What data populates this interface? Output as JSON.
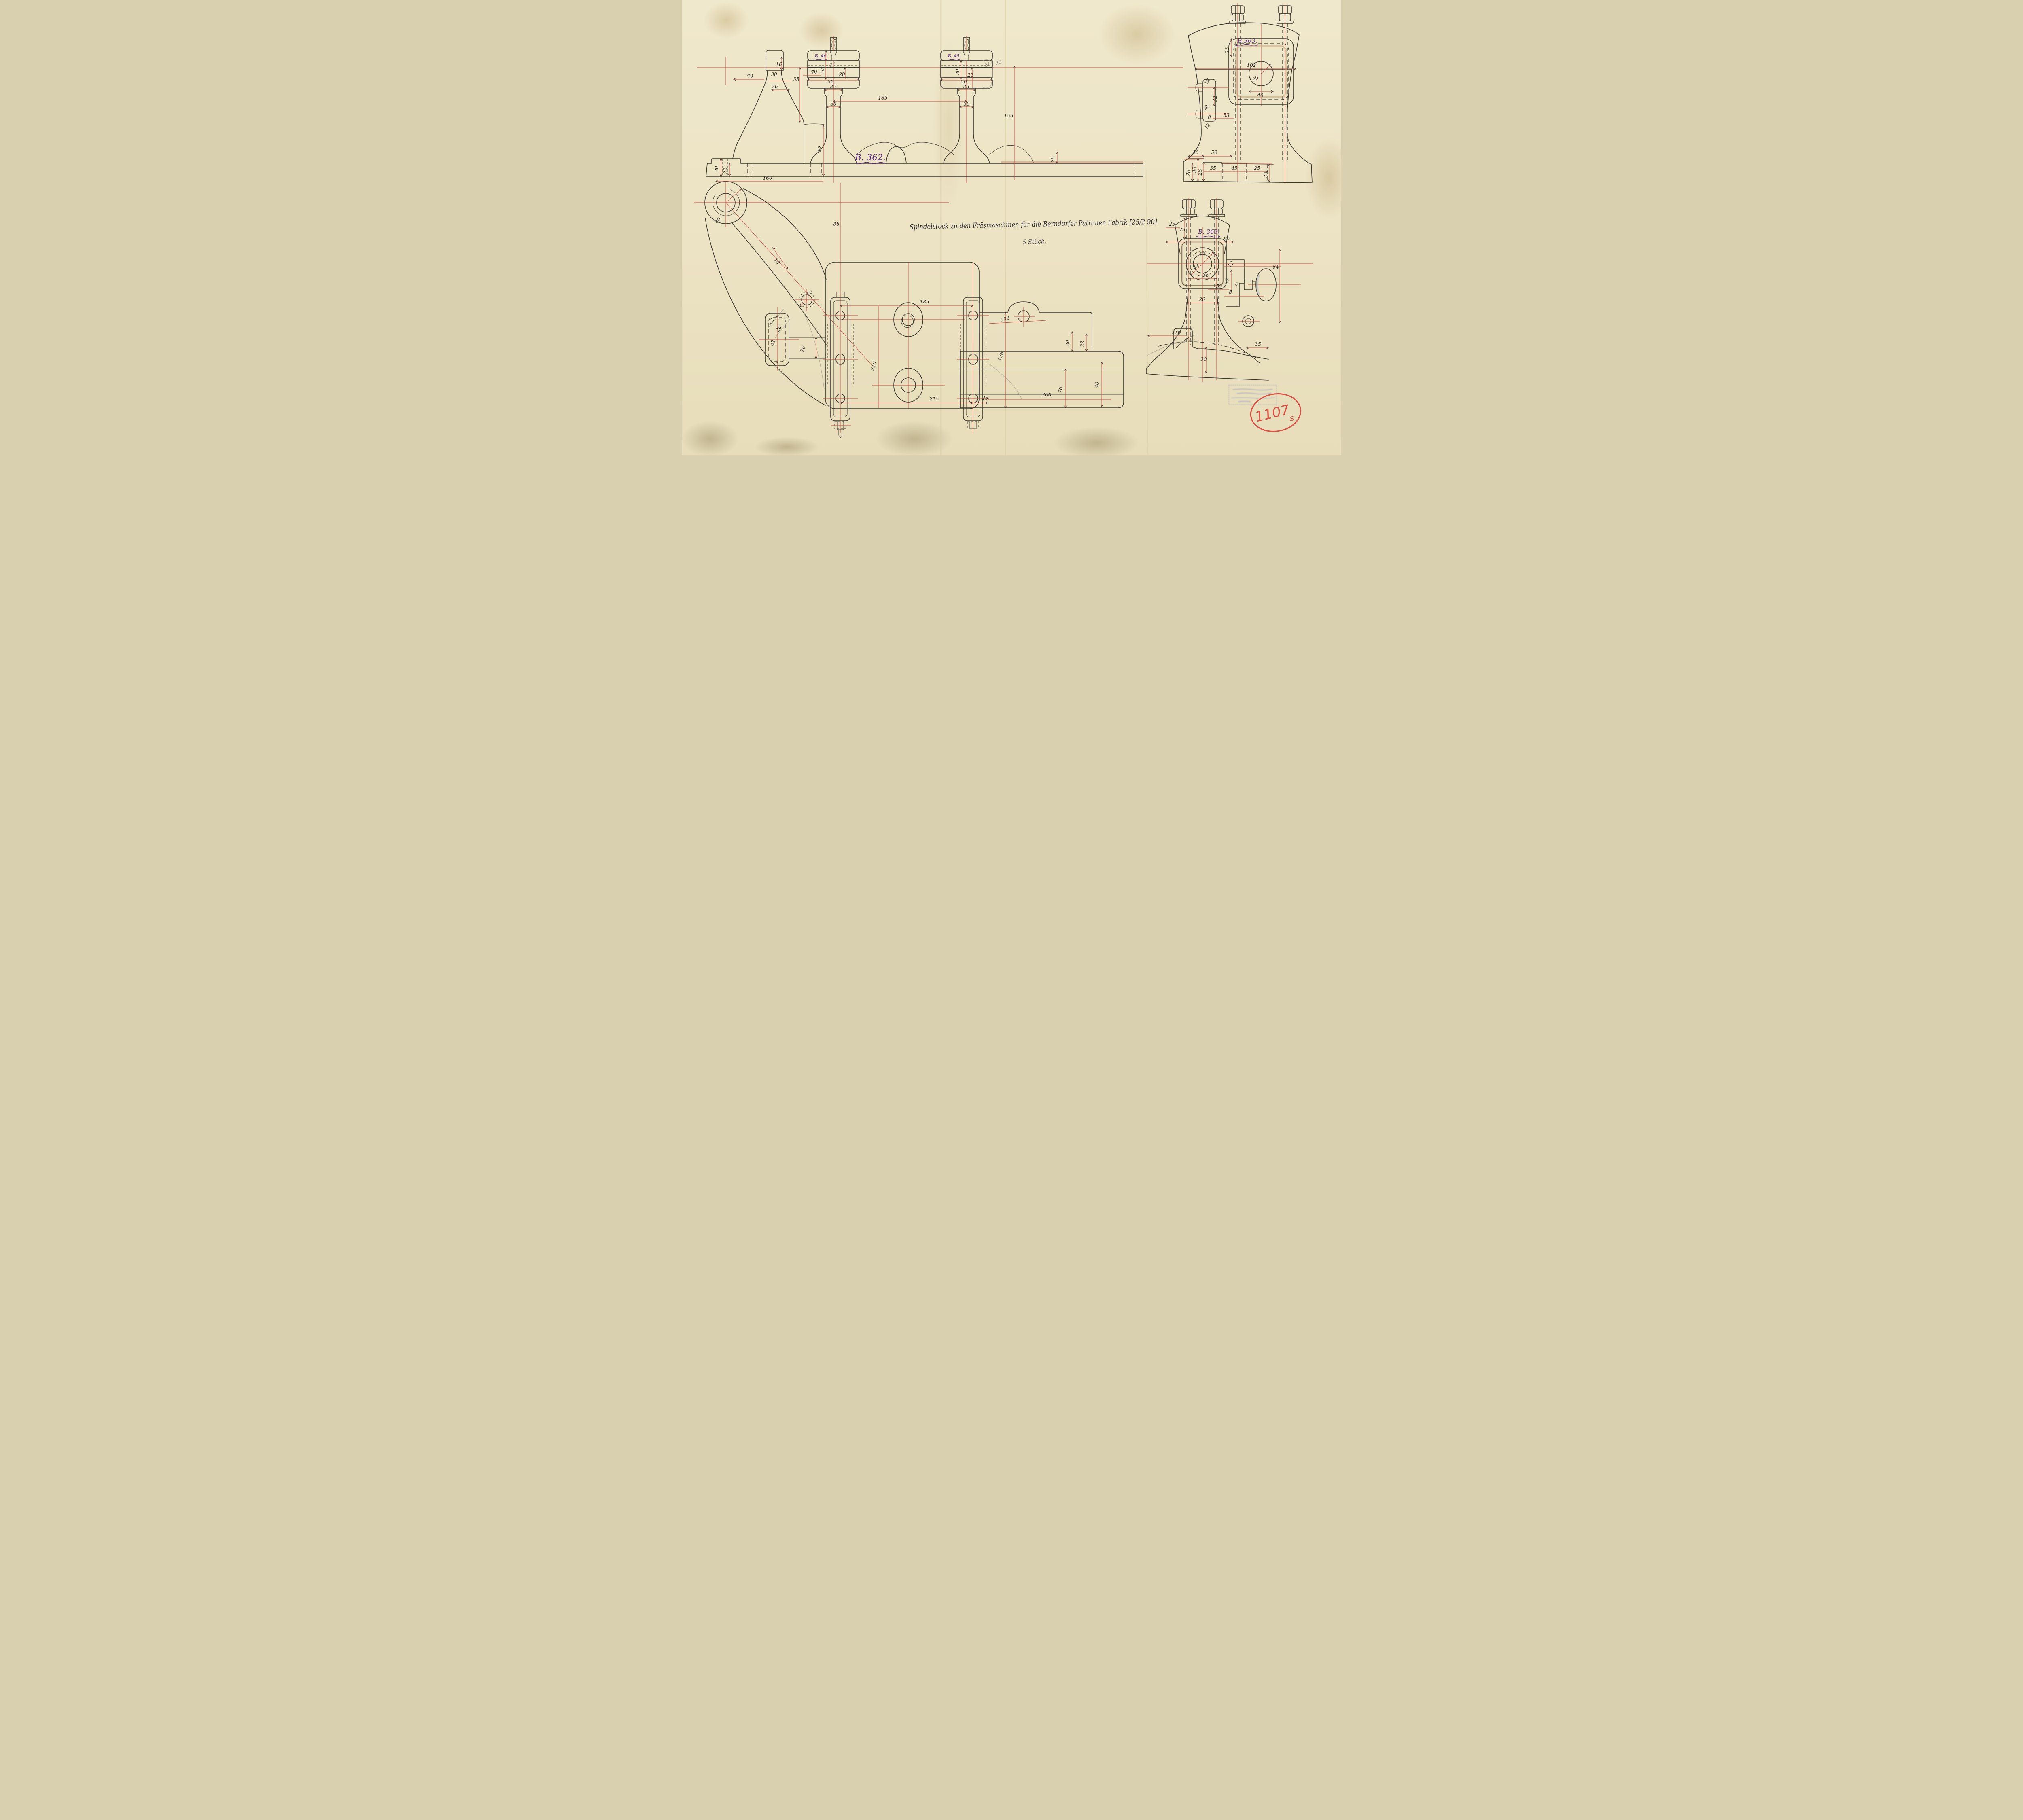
{
  "title": {
    "line1": "Spindelstock zu den Fräsmaschinen für die Berndorfer Patronen Fabrik [25/2 90]",
    "line2": "5 Stück."
  },
  "labels": {
    "b362": "B. 362.",
    "b46": "B. 46.",
    "b45": "B. 45.",
    "b363_front": "B.363.",
    "b363_side": "B. 363."
  },
  "stamp": {
    "number": "1107",
    "suffix": "s"
  },
  "colors": {
    "paper": "#eee6c9",
    "ink": "#3d382e",
    "red_line": "#c2463e",
    "purple_ink": "#5a2a86",
    "stamp_red": "#dd4f44",
    "pencil": "#a59d8c"
  },
  "views": {
    "a": {
      "name": "side elevation B.362",
      "dims": {
        "a1": "16",
        "a2": "30",
        "a3": "26",
        "a4": "70",
        "a5": "35",
        "a6": "70",
        "a7": "25",
        "a8": "30",
        "a9": "20",
        "a10": "50",
        "a11": "35",
        "a12": "30",
        "a13": "23",
        "a14": "50",
        "a15": "35",
        "a16": "30",
        "a17": "185",
        "a18": "30",
        "a19": "30",
        "a20": "155",
        "a21": "30",
        "a22": "55",
        "a23": "30",
        "a24": "22",
        "a25": "160",
        "a26": "26"
      }
    },
    "b": {
      "name": "front elevation pedestal B.363",
      "dims": {
        "b1": "23",
        "b2": "102",
        "b3": "30",
        "b4": "40",
        "b5": "12",
        "b6": "32",
        "b7": "30",
        "b8": "8",
        "b9": "12",
        "b10": "53",
        "b11": "40",
        "b12": "50",
        "b13": "70",
        "b14": "30",
        "b15": "26",
        "b16": "35",
        "b17": "45",
        "b18": "25",
        "b19": "22"
      }
    },
    "c": {
      "name": "plan view",
      "dims": {
        "c1": "40",
        "c2": "18",
        "c3": "88",
        "c4": "16",
        "c5": "12",
        "c6": "20",
        "c7": "42",
        "c8": "26",
        "c9": "185",
        "c10": "102",
        "c11": "210",
        "c12": "128",
        "c13": "30",
        "c14": "22",
        "c15": "70",
        "c16": "40",
        "c17": "215",
        "c18": "25",
        "c19": "200"
      }
    },
    "d": {
      "name": "side elevation pedestal B.363",
      "dims": {
        "d1": "25",
        "d2": "23",
        "d3": "95",
        "d4": "42",
        "d5": "35",
        "d6": "12",
        "d7": "30",
        "d8": "8",
        "d9": "53",
        "d10": "6",
        "d11": "64",
        "d12": "26",
        "d13": "210",
        "d14": "30",
        "d15": "35"
      }
    }
  }
}
